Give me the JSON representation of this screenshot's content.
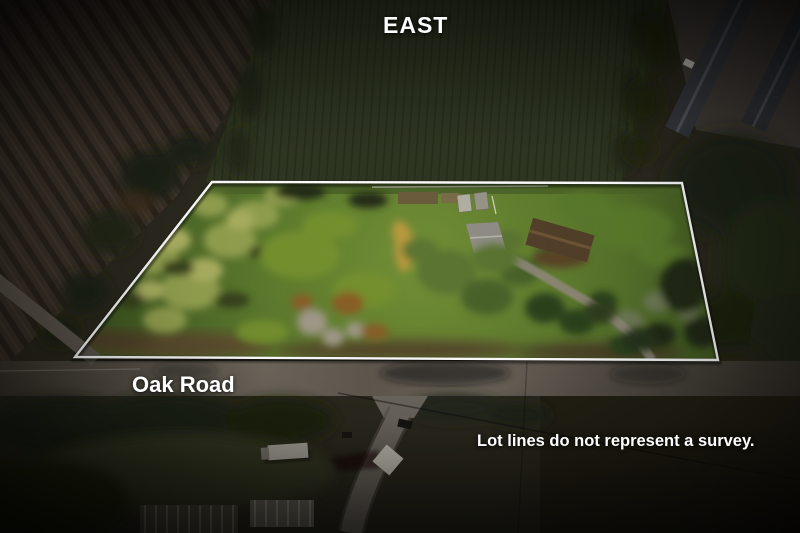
{
  "overlay": {
    "direction_label": "EAST",
    "road_label": "Oak Road",
    "disclaimer": "Lot lines do not represent a survey.",
    "text_color": "#ffffff"
  },
  "lot": {
    "points": "212,182 682,183 718,360 75,357",
    "outline_color": "#ffffff"
  },
  "palette": {
    "lawn_green": "#6f8d35",
    "autumn_yellow": "#a8ab5f",
    "dark_trees": "#222c15",
    "plowed_field_brown": "#3c332a",
    "crop_field_green": "#2f3722",
    "road_gray": "#6e675c",
    "roof_gray": "#8f8d85",
    "barn_roof_brown": "#53402a"
  }
}
